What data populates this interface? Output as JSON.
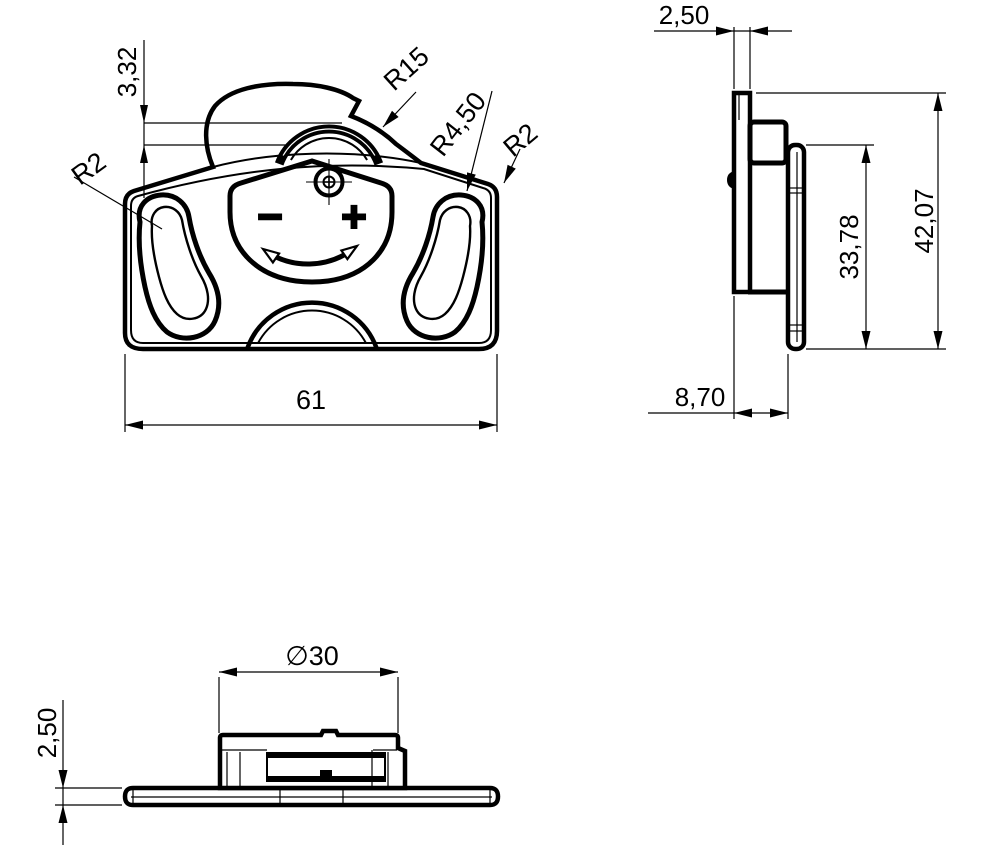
{
  "colors": {
    "background": "#ffffff",
    "line": "#000000"
  },
  "front_view": {
    "dim_offset": "3,32",
    "dim_radius_bump": "R15",
    "dim_radius_recess": "R4,50",
    "dim_radius_corner_right": "R2",
    "dim_radius_corner_left": "R2",
    "dim_width": "61",
    "minus_symbol": "−",
    "plus_symbol": "+"
  },
  "side_view": {
    "dim_thickness": "2,50",
    "dim_total_height": "42,07",
    "dim_plate_height": "33,78",
    "dim_depth": "8,70"
  },
  "bottom_view": {
    "dim_diameter": "∅30",
    "dim_thickness": "2,50"
  }
}
